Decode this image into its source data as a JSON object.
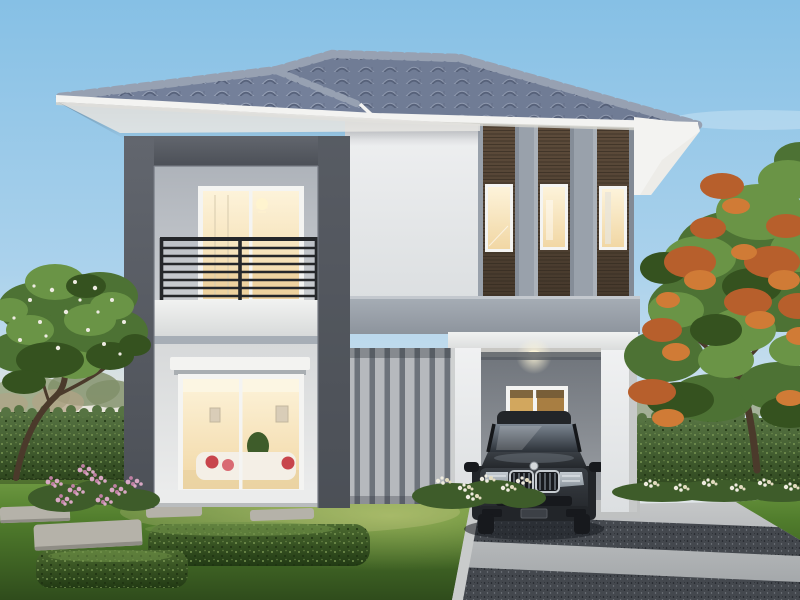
{
  "meta": {
    "description": "Architectural render of a modern two-storey detached house at dusk: grey hipped tile roof, white and charcoal facade, balcony with black railing, timber-slat feature windows, warm interior lighting, carport with dark luxury sedan, landscaped lawn, hedges and trees",
    "time_of_day": "dusk",
    "visible_text": []
  },
  "scene": {
    "house": {
      "storeys": 2,
      "features": [
        "hipped-tile-roof",
        "balcony",
        "portal-frame",
        "timber-slat-windows",
        "vertical-slat-screen",
        "carport",
        "picture-window"
      ]
    },
    "vehicle": {
      "type": "dark luxury sedan",
      "position": "carport"
    },
    "landscape": [
      "left-flowering-tree",
      "right-flame-tree",
      "boundary-hedges",
      "stepping-stones",
      "box-hedges",
      "flower-beds",
      "striped-driveway"
    ]
  },
  "colors": {
    "sky_top": "#86c0e5",
    "sky_mid": "#abd2ec",
    "sky_low": "#d8e5ee",
    "sky_horizon": "#f2ebe2",
    "sun_glow": "#ffe9cd",
    "roof_base": "#74809a",
    "roof_dark": "#57627b",
    "roof_light": "#a2adc0",
    "roof_ridge": "#97a1b2",
    "roof_shade": "#4a5570",
    "fascia": "#f3f3f1",
    "fascia_shade": "#d2d2cd",
    "soffit": "#e9e8e4",
    "soffit_shade": "#bbbab6",
    "frame_1": "#62666e",
    "frame_2": "#4c5057",
    "wall_1": "#f0f1f2",
    "wall_2": "#dcdfe1",
    "wall_edge": "#c7c9c9",
    "inner_1": "#aeb3ba",
    "inner_2": "#cbced2",
    "gfloor_1": "#d7d9da",
    "gfloor_2": "#ebecec",
    "slab_1": "#a7aeb6",
    "slab_2": "#8d949d",
    "beam_1": "#f1f2f1",
    "beam_2": "#d8dada",
    "pilaster": "#99a1ab",
    "pilaster_dark": "#7c8490",
    "wood_1": "#5f4d3c",
    "wood_2": "#46392c",
    "wood_line": "#2f261c",
    "win_frame": "#f4f4f2",
    "glass_1": "#fdf3da",
    "glass_2": "#f1d7a4",
    "glass_cool": "#e9e5d9",
    "railing": "#25272a",
    "slat_light": "#b6b9bd",
    "slat_dark": "#6d737b",
    "carport_1": "#6e737a",
    "carport_2": "#9da1a6",
    "carport_ceiling": "#c8c7c3",
    "lamp": "#fff7da",
    "gold_1": "#d2a75e",
    "gold_2": "#a87e42",
    "drive_1": "#c5c7c8",
    "drive_2": "#9da1a4",
    "drive_dark": "#44484e",
    "curb": "#c9cbcb",
    "grass_1": "#6f9a42",
    "grass_2": "#507c2c",
    "grass_3": "#2f4c1c",
    "grass_hi": "#c9d77a",
    "hedge_1": "#567342",
    "hedge_2": "#2c441c",
    "hedge_dot": "#7d9a57",
    "hedge_dot_dark": "#1d3110",
    "box_1": "#4c6a30",
    "box_2": "#223a14",
    "box_hi": "#6f9147",
    "stone": "#b5b2a9",
    "stone_shade": "#8f8d85",
    "pink_1": "#d9a8c4",
    "pink_2": "#c080a4",
    "bloom_white": "#efece0",
    "bloom_cream": "#e3dcc0",
    "bed_green": "#3e5c2a",
    "leaf_1": "#4d7234",
    "leaf_2": "#6a9446",
    "leaf_3": "#35521f",
    "orange_1": "#b75f2c",
    "orange_2": "#d07b36",
    "trunk": "#4b3a2b",
    "bg_1": "#97a37f",
    "bg_2": "#7f8f68",
    "bg_tan": "#b2a386",
    "car_1": "#3a3f45",
    "car_2": "#222529",
    "car_3": "#17191d",
    "car_glass_1": "#7b8591",
    "car_glass_2": "#2c3138",
    "chrome": "#c7ccd1",
    "headlight_1": "#c4cbd1",
    "headlight_2": "#8d969e",
    "car_shadow": "#171b20"
  }
}
